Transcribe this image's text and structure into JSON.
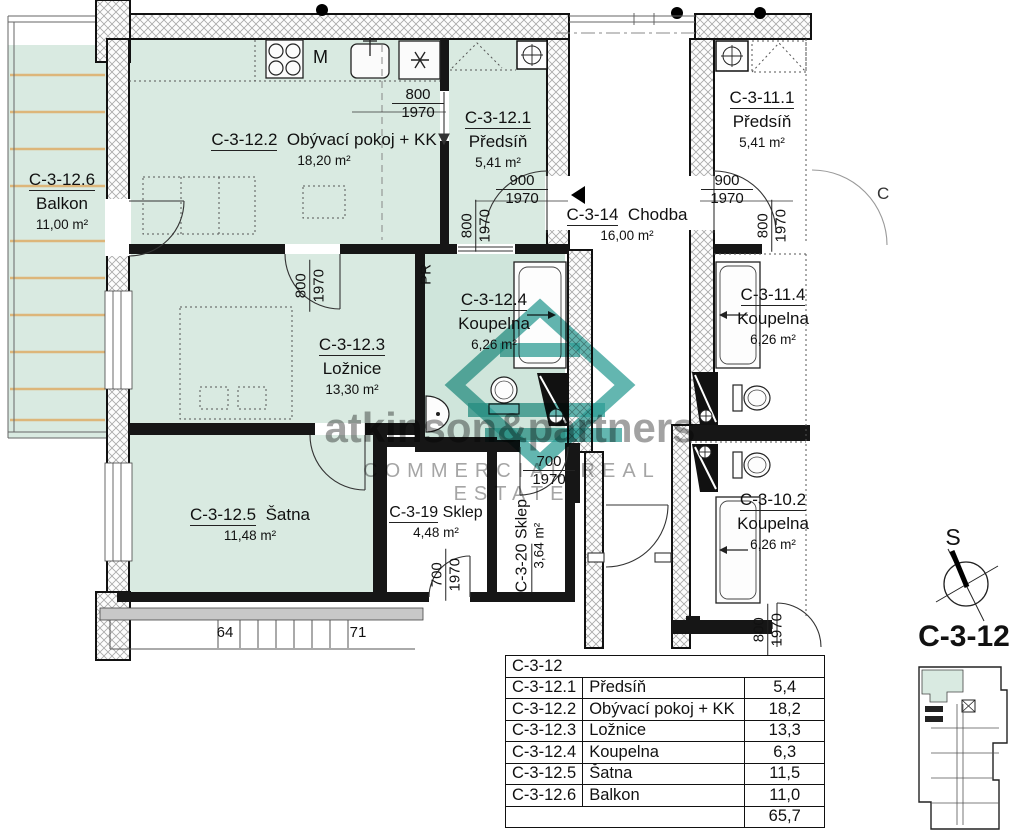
{
  "plan_title": "C-3-12",
  "compass": {
    "south_label": "S"
  },
  "watermark": {
    "brand": "atkinson&partners",
    "tagline": "COMMERCIAL REAL ESTATE"
  },
  "partial_label": "C",
  "colors": {
    "room_fill": "#d9eae1",
    "bath_fill": "#cfe5db",
    "deck_line": "#ddb67a",
    "logo_teal": "#2f9e96",
    "wall_gray": "#c8c8c8"
  },
  "icons": {
    "dishwasher": "asterisk-icon",
    "entrance": "triangle-left-icon",
    "north_ref": "compass-icon"
  },
  "rooms": {
    "balkon": {
      "id": "C-3-12.6",
      "name": "Balkon",
      "area": "11,00 m²"
    },
    "obyvaci": {
      "id": "C-3-12.2",
      "name": "Obývací pokoj + KK",
      "area": "18,20 m²"
    },
    "predsin": {
      "id": "C-3-12.1",
      "name": "Předsíň",
      "area": "5,41 m²"
    },
    "predsin2": {
      "id": "C-3-11.1",
      "name": "Předsíň",
      "area": "5,41 m²"
    },
    "chodba": {
      "id": "C-3-14",
      "name": "Chodba",
      "area": "16,00 m²"
    },
    "loznice": {
      "id": "C-3-12.3",
      "name": "Ložnice",
      "area": "13,30 m²"
    },
    "koupelna": {
      "id": "C-3-12.4",
      "name": "Koupelna",
      "area": "6,26 m²"
    },
    "koupelna2": {
      "id": "C-3-11.4",
      "name": "Koupelna",
      "area": "6,26 m²"
    },
    "koupelna3": {
      "id": "C-3-10.2",
      "name": "Koupelna",
      "area": "6,26 m²"
    },
    "satna": {
      "id": "C-3-12.5",
      "name": "Šatna",
      "area": "11,48 m²"
    },
    "sklep19": {
      "id": "C-3-19",
      "name": "Sklep",
      "area": "4,48 m²"
    },
    "sklep20": {
      "id": "C-3-20",
      "name": "Sklep",
      "area": "3,64 m²"
    }
  },
  "fixtures": {
    "pr": "PR",
    "microwave": "M"
  },
  "doors": {
    "living_hall": {
      "w": "800",
      "h": "1970"
    },
    "entry": {
      "w": "900",
      "h": "1970"
    },
    "entry_side": {
      "w": "800",
      "h": "1970"
    },
    "neighbor_entry": {
      "w": "900",
      "h": "1970"
    },
    "neighbor_entry_side": {
      "w": "800",
      "h": "1970"
    },
    "loznice": {
      "w": "800",
      "h": "1970"
    },
    "sklep19": {
      "w": "700",
      "h": "1970"
    },
    "sklep20": {
      "w": "700",
      "h": "1970"
    },
    "koupelna102": {
      "w": "800",
      "h": "1970"
    }
  },
  "stairs": {
    "first": "64",
    "last": "71"
  },
  "table": {
    "title": "C-3-12",
    "rows": [
      {
        "id": "C-3-12.1",
        "name": "Předsíň",
        "area": "5,4"
      },
      {
        "id": "C-3-12.2",
        "name": "Obývací pokoj + KK",
        "area": "18,2"
      },
      {
        "id": "C-3-12.3",
        "name": "Ložnice",
        "area": "13,3"
      },
      {
        "id": "C-3-12.4",
        "name": "Koupelna",
        "area": "6,3"
      },
      {
        "id": "C-3-12.5",
        "name": "Šatna",
        "area": "11,5"
      },
      {
        "id": "C-3-12.6",
        "name": "Balkon",
        "area": "11,0"
      }
    ],
    "total": "65,7"
  }
}
